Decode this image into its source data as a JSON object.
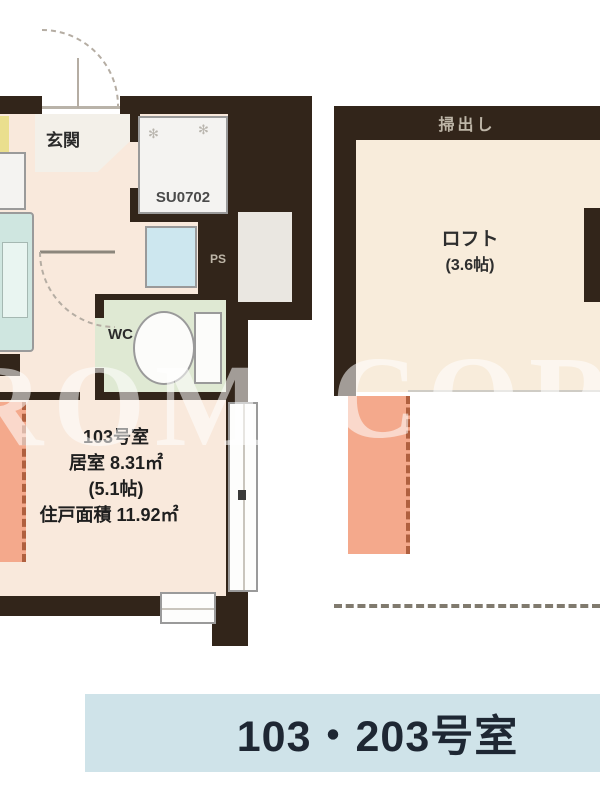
{
  "page_title": "103・203号室 間取り図",
  "colors": {
    "wall": "#32251a",
    "room": "#f9e9dc",
    "genkan": "#f3f0e9",
    "loftfloor": "#f8ecdb",
    "wcgreen": "#dfe9d3",
    "waterblue": "#cde7ef",
    "kitteal": "#cfe6e0",
    "salmon": "#f4a98c",
    "salmondash": "#b0603f",
    "footerblue": "#cfe3e9",
    "yellow": "#eadf8e",
    "ink": "#222222",
    "walltext": "#beb6a8"
  },
  "main_plan": {
    "entrance_label": "玄関",
    "shower_unit_label": "SU0702",
    "pipe_space_label": "PS",
    "wc_label": "WC",
    "room_info": [
      "103号室",
      "居室 8.31㎡",
      "(5.1帖)",
      "住戸面積 11.92㎡"
    ]
  },
  "loft_plan": {
    "wall_label": "掃出し",
    "loft_label": "ロフト",
    "loft_size": "(3.6帖)"
  },
  "watermark": {
    "left": "ROM",
    "right": "CORP"
  },
  "footer": {
    "label": "103・203号室"
  }
}
